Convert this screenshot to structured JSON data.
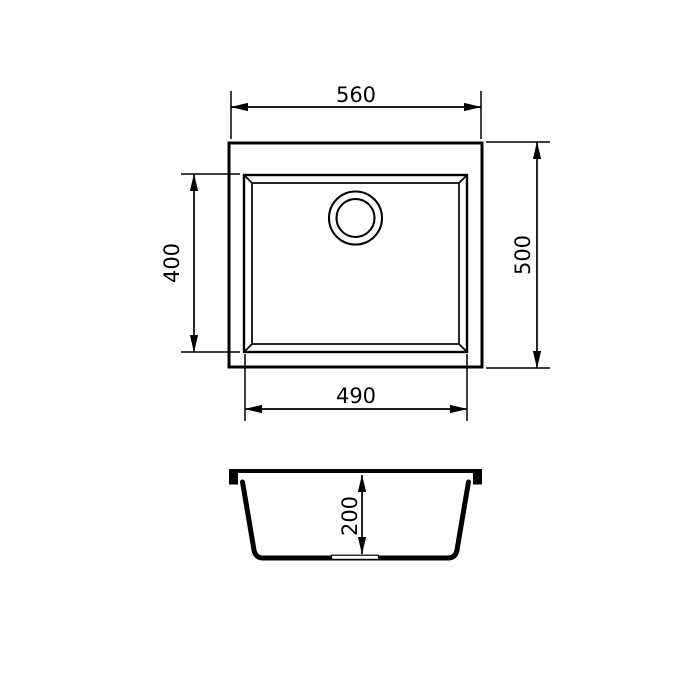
{
  "drawing": {
    "title": "sink-dimensions-technical-drawing",
    "colors": {
      "line": "#000000",
      "background": "#ffffff"
    },
    "top_view": {
      "overall_width": "560",
      "overall_depth": "500",
      "bowl_width": "490",
      "bowl_depth": "400"
    },
    "section_view": {
      "bowl_height": "200"
    }
  }
}
